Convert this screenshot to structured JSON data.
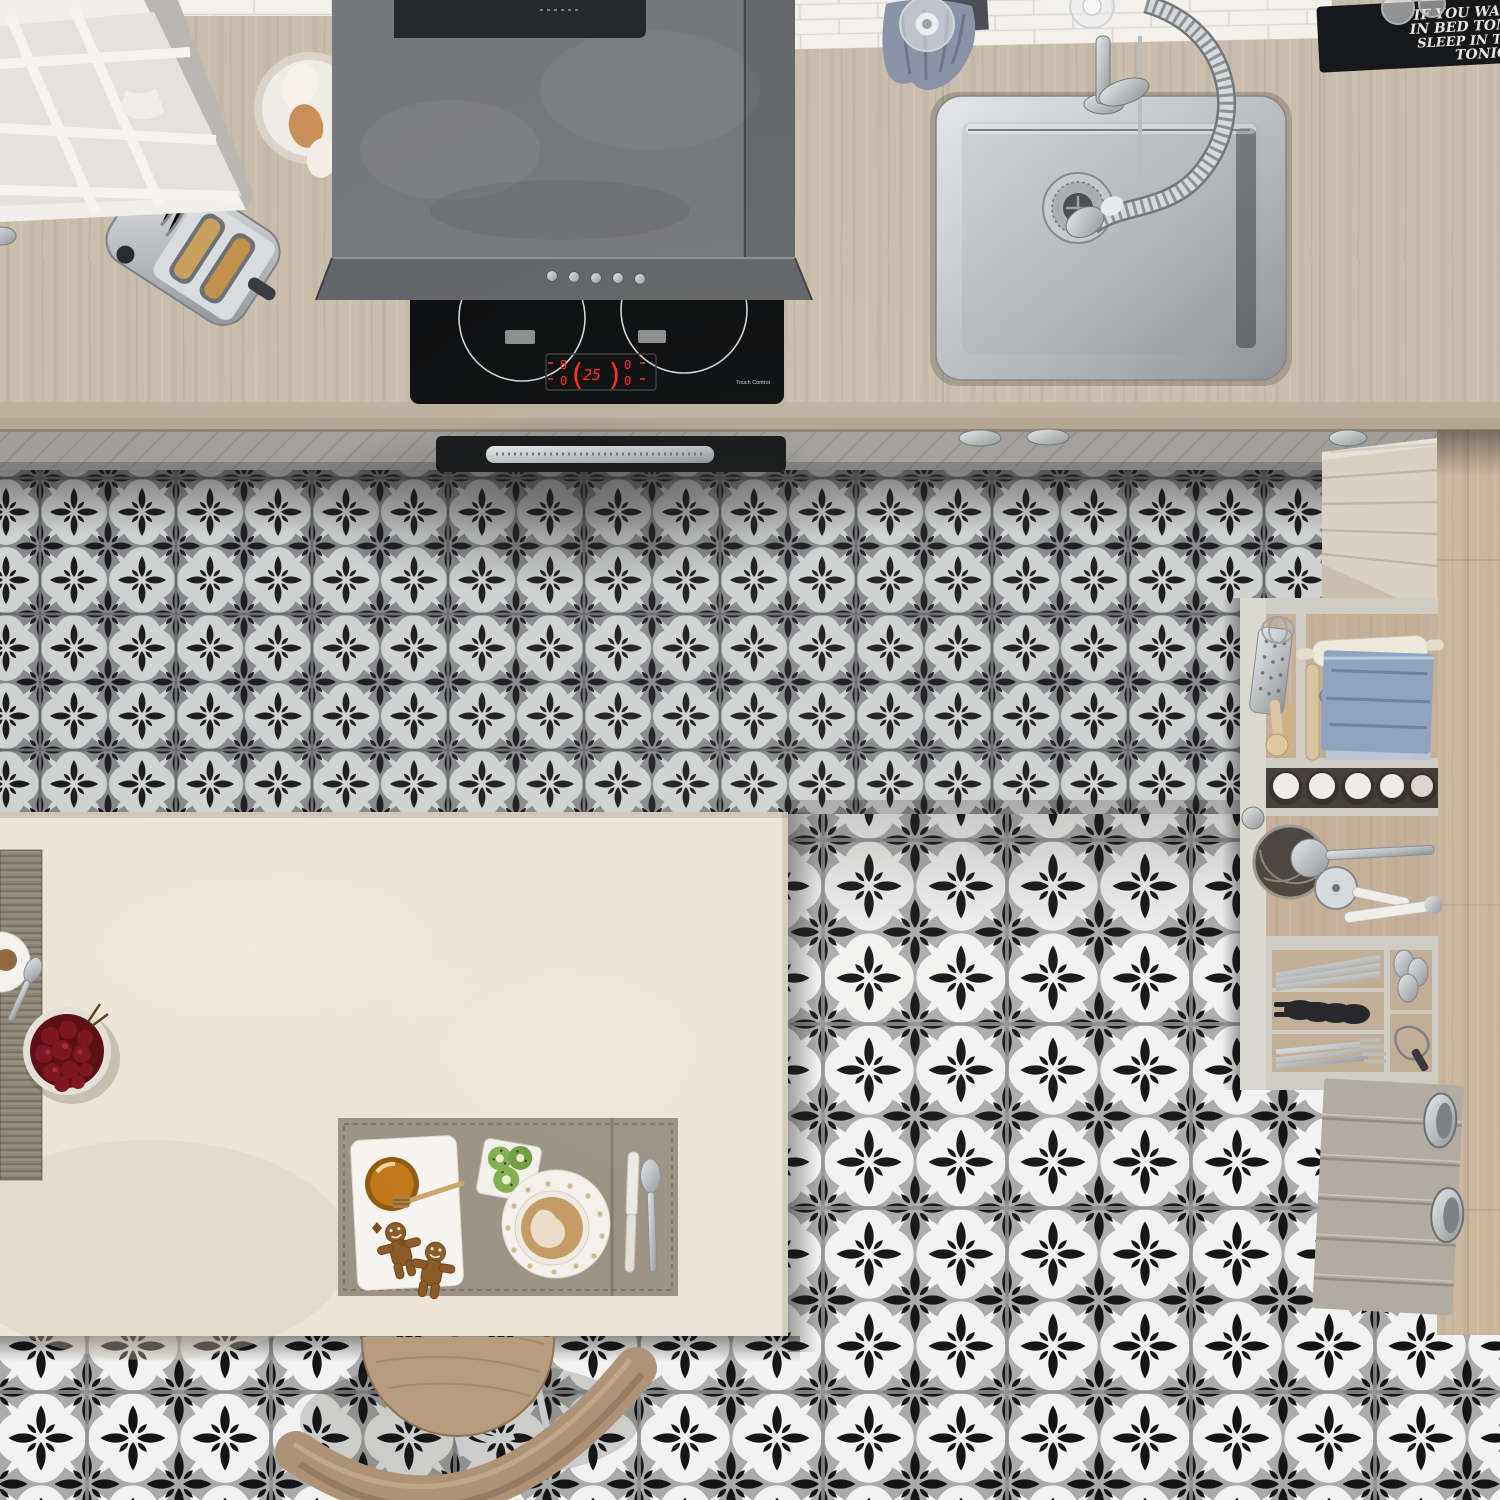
{
  "scene": {
    "description": "top-down view of a kitchen with patterned grey/black/white floor tiles, wooden worktop, hob, sink, open utensil drawer and breakfast island"
  },
  "colors": {
    "woodCounter": "#c9bead",
    "woodFloor": "#cbb99f",
    "island": "#ece4d7",
    "fascia": "#a09e99",
    "tileDarkGround": "#85878a",
    "tileDarkLight": "#ced1d0",
    "tileLightGround": "#a9abaa",
    "tileLightLight": "#f1f2f1",
    "tileBlack": "#17181a",
    "hoodBody": "#76787b",
    "hoodPanel": "#27282a",
    "cooktop": "#0b0c0d",
    "ledRed": "#ff2d1a",
    "steel": "#c9ccce",
    "matBlack": "#17181a",
    "doorUpper": "#d8d0c3",
    "doorLower": "#b2aba1",
    "drawerWood": "#c4b098",
    "towelBlue": "#8a93a6",
    "clothBlue": "#8fa3bf",
    "honey": "#c07818",
    "coffee": "#c59a63",
    "cherry": "#7d1822"
  },
  "mat": {
    "lines": [
      "IF YOU WAN",
      "IN BED TOM",
      "SLEEP IN TH",
      "TONIG"
    ]
  },
  "cooktop": {
    "display": {
      "left_top": "8",
      "left_bottom": "0",
      "bracket_left": "(",
      "center": "25",
      "bracket_right": ")",
      "right_top": "0",
      "right_bottom": "0"
    },
    "touch_label": "Touch Control"
  }
}
